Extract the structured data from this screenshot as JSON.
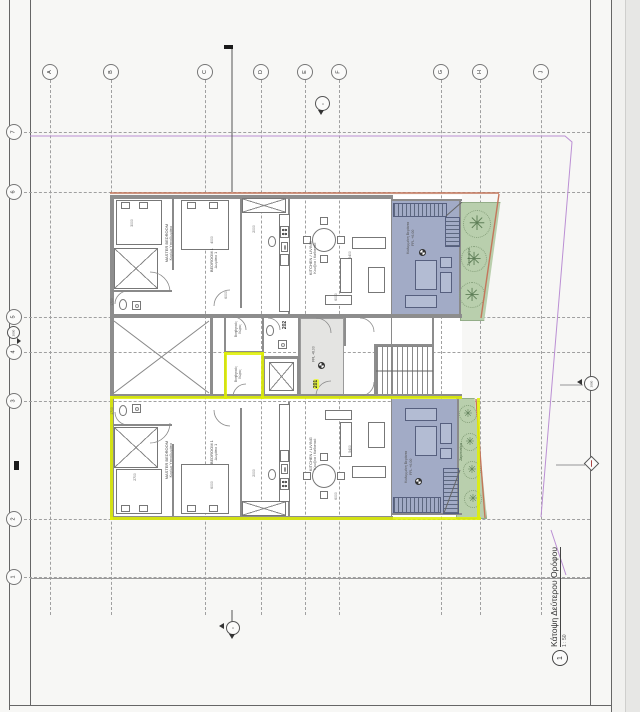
{
  "sheet": {
    "title": "Κάτοψη Δεύτερου Ορόφου",
    "detail_number": "1",
    "scale": "1 : 50"
  },
  "grid": {
    "columns": [
      {
        "label": "A",
        "x": 50
      },
      {
        "label": "B",
        "x": 111
      },
      {
        "label": "C",
        "x": 205
      },
      {
        "label": "D",
        "x": 261
      },
      {
        "label": "E",
        "x": 305
      },
      {
        "label": "F",
        "x": 339
      },
      {
        "label": "G",
        "x": 441
      },
      {
        "label": "H",
        "x": 480
      },
      {
        "label": "J",
        "x": 541
      }
    ],
    "rows": [
      {
        "label": "7",
        "y": 132
      },
      {
        "label": "6",
        "y": 192
      },
      {
        "label": "5",
        "y": 317
      },
      {
        "label": "4",
        "y": 352
      },
      {
        "label": "3",
        "y": 401
      },
      {
        "label": "2",
        "y": 519
      },
      {
        "label": "1",
        "y": 577
      }
    ]
  },
  "units": {
    "upper": {
      "number": "202",
      "master_en": "MASTER BEDROOM",
      "master_gr": "Κυρίως Υπνοδωμάτιο",
      "bedroom_en": "BEDROOM 1",
      "bedroom_gr": "Δωμάτιο 1",
      "living_en": "Kitchen / Living",
      "living_gr": "Κουζίνα / Καθιστικό",
      "veranda_gr": "Καλυμμένη Βεράντα",
      "veranda_level": "FFL +6.00",
      "service_1": "Βοηθητικός",
      "service_2": "Χώρος",
      "planter": "Ζαρντινιέρα"
    },
    "lower": {
      "number": "201",
      "master_en": "MASTER BEDROOM",
      "master_gr": "Κυρίως Υπνοδωμάτιο",
      "bedroom_en": "BEDROOM 1",
      "bedroom_gr": "Δωμάτιο 1",
      "living_en": "Kitchen / Living",
      "living_gr": "Κουζίνα / Καθιστικό",
      "veranda_gr": "Καλυμμένη Βεράντα",
      "veranda_level": "FFL +6.00",
      "service_1": "Βοηθητικός",
      "service_2": "Χώρος",
      "planter": "Ζαρντινιέρα"
    }
  },
  "lobby": {
    "level": "FFL +6.00"
  },
  "markers": {
    "left_datum": "2000",
    "right_datum": "2000"
  },
  "dimensions": [
    {
      "text": "3000",
      "x": 137,
      "y": 224
    },
    {
      "text": "4000",
      "x": 217,
      "y": 241
    },
    {
      "text": "2000",
      "x": 259,
      "y": 230
    },
    {
      "text": "5400",
      "x": 355,
      "y": 256
    },
    {
      "text": "6000",
      "x": 341,
      "y": 298
    },
    {
      "text": "6000",
      "x": 231,
      "y": 296
    },
    {
      "text": "2700",
      "x": 140,
      "y": 478
    },
    {
      "text": "6000",
      "x": 217,
      "y": 486
    },
    {
      "text": "5400",
      "x": 355,
      "y": 450
    },
    {
      "text": "6000",
      "x": 341,
      "y": 497
    },
    {
      "text": "2000",
      "x": 259,
      "y": 474
    },
    {
      "text": "1700",
      "x": 117,
      "y": 303
    },
    {
      "text": "1700",
      "x": 117,
      "y": 412
    }
  ],
  "colors": {
    "wall": "#8d8d8d",
    "veranda": "#a2abc6",
    "garden": "#b9cfad",
    "highlight": "#dff000",
    "property_line": "#bb8fd4",
    "exterior_line": "#c4765b"
  }
}
